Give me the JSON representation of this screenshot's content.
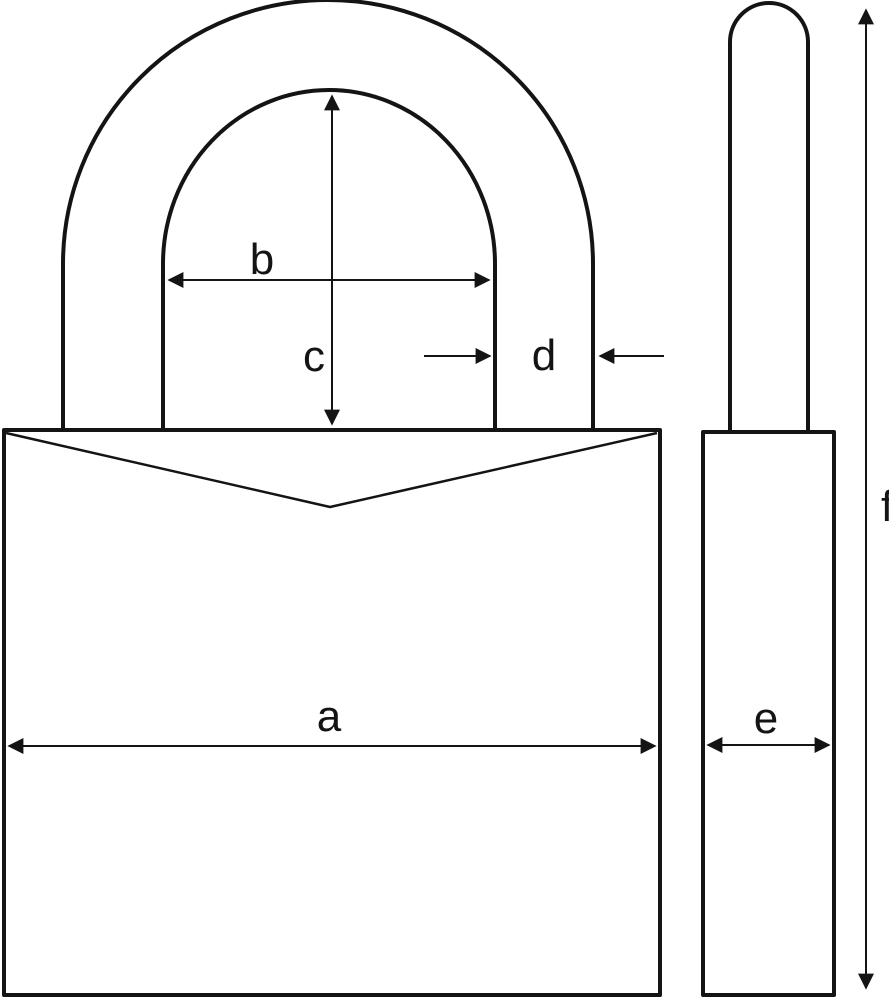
{
  "diagram": {
    "background_color": "#ffffff",
    "line_color": "#141414",
    "labels": {
      "a": "a",
      "b": "b",
      "c": "c",
      "d": "d",
      "e": "e",
      "f": "f"
    }
  }
}
